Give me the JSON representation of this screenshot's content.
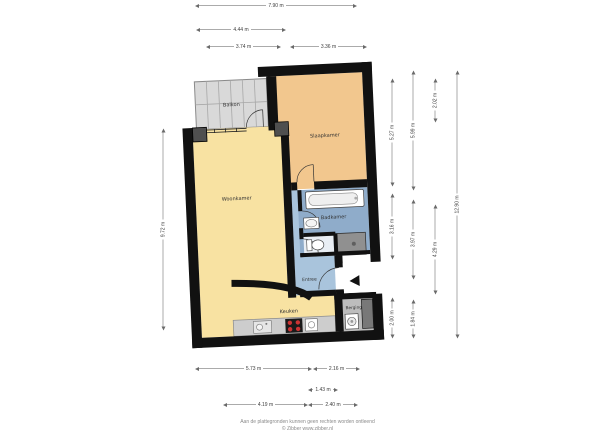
{
  "rooms": {
    "balkon": "Balkon",
    "slaapkamer": "Slaapkamer",
    "woonkamer": "Woonkamer",
    "badkamer": "Badkamer",
    "entree": "Entree",
    "keuken": "Keuken",
    "berging": "Berging"
  },
  "dims": {
    "t1": "7.90 m",
    "t2": "4.44 m",
    "t3": "3.74 m",
    "t4": "3.36 m",
    "b1": "5.73 m",
    "b2": "2.16 m",
    "b3": "1.43 m",
    "b4": "4.19 m",
    "b5": "2.40 m",
    "l1": "9.72 m",
    "r1": "5.27 m",
    "r2": "3.16 m",
    "r3": "2.00 m",
    "r4": "5.99 m",
    "r5": "3.97 m",
    "r6": "1.84 m",
    "r7": "2.02 m",
    "r8": "4.29 m",
    "r9": "12.90 m"
  },
  "footer": {
    "line1": "Aan de plattegronden kunnen geen rechten worden ontleend",
    "line2": "© Zibber www.zibber.nl"
  },
  "fixtures": {
    "bathtub": "bathtub",
    "washbasin": "washbasin",
    "toilet": "toilet",
    "shower": "shower",
    "washing_machine": "washing machine",
    "stove": "stove",
    "sink": "kitchen sink",
    "counter": "kitchen counter",
    "shaft": "duct shaft",
    "entrance_arrow": "entrance direction"
  },
  "colors": {
    "wall": "#111111",
    "woonkamer_keuken": "#F8E2A2",
    "slaapkamer": "#F2C78E",
    "badkamer": "#8FACCA",
    "entree": "#A9C4DC",
    "berging": "#BDBDBD",
    "balkon": "#D9D9D9",
    "shower": "#909090",
    "counter": "#CDCDCD",
    "stove_burner": "#CC3333",
    "entrance_arrow": "#111111",
    "dimension_text": "#444444"
  }
}
